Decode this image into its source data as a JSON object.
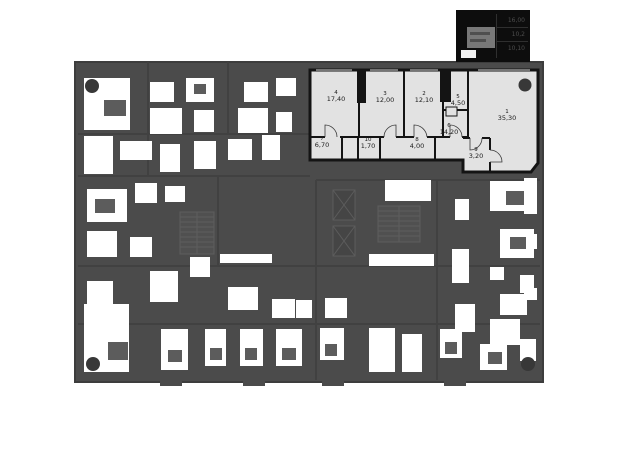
{
  "floorplan": {
    "colors": {
      "dim_base": "#4b4b4b",
      "dim_border": "#3d3d3d",
      "dim_room": "#ffffff",
      "dim_furniture": "#5c5c5c",
      "highlight_fill": "#e2e2e2",
      "wall": "#141414",
      "label_text": "#1b1b1b",
      "column": "#383838"
    },
    "apartment": {
      "rooms": [
        {
          "number": "1",
          "area": "35,30",
          "x": 507,
          "y": 109
        },
        {
          "number": "2",
          "area": "12,10",
          "x": 424,
          "y": 91
        },
        {
          "number": "3",
          "area": "12,00",
          "x": 385,
          "y": 91
        },
        {
          "number": "4",
          "area": "17,40",
          "x": 336,
          "y": 90
        },
        {
          "number": "5",
          "area": "4,50",
          "x": 458,
          "y": 94
        },
        {
          "number": "6",
          "area": "14,20",
          "x": 449,
          "y": 123
        },
        {
          "number": "7",
          "area": "6,70",
          "x": 322,
          "y": 136
        },
        {
          "number": "8",
          "area": "4,00",
          "x": 417,
          "y": 137
        },
        {
          "number": "9",
          "area": "3,20",
          "x": 476,
          "y": 147
        },
        {
          "number": "10",
          "area": "1,70",
          "x": 368,
          "y": 137
        }
      ]
    },
    "minimap": {
      "values": [
        "16,00",
        "10,2",
        "10,10"
      ]
    }
  }
}
